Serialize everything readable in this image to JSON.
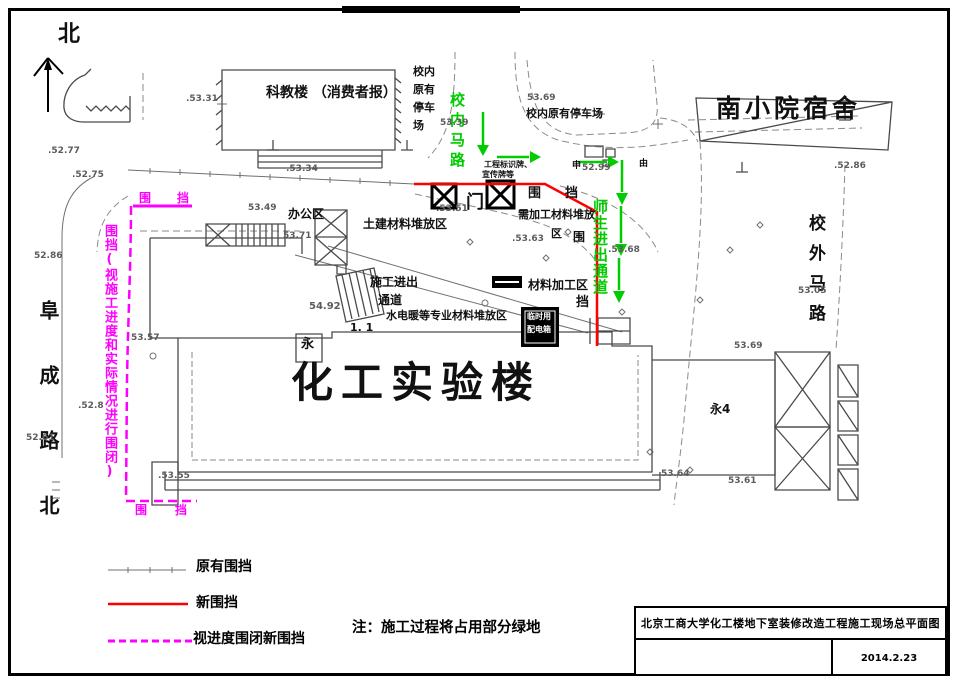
{
  "colors": {
    "text": {
      "k": "#111111",
      "g": "#5c5c5c",
      "green": "#00cc00",
      "m": "#ff00ff",
      "w": "#ffffff"
    },
    "red": "#ff0000",
    "magenta": "#ff00ff",
    "green_line": "#00cc00",
    "gray": "#8a8a8a"
  },
  "legend": {
    "items": [
      {
        "label": "原有围挡",
        "style": "existing-gray-tick-line"
      },
      {
        "label": "新围挡",
        "style": "new-red-solid-line"
      },
      {
        "label": "视进度围闭新围挡",
        "style": "progress-magenta-dashed-line"
      }
    ]
  },
  "note": "注：施工过程将占用部分绿地",
  "title_block": {
    "title": "北京工商大学化工楼地下室装修改造工程施工现场总平面图",
    "date": "2014.2.23"
  },
  "labels": [
    {
      "t": "北",
      "x": 58,
      "y": 24,
      "s": 22,
      "n": "north-label"
    },
    {
      "t": "科教楼 （消费者报）",
      "x": 266,
      "y": 86,
      "s": 14,
      "n": "building-kejiaolou"
    },
    {
      "t": "校内",
      "x": 413,
      "y": 66,
      "s": 11,
      "n": "parking-vertical-label"
    },
    {
      "t": "原有",
      "x": 413,
      "y": 84,
      "s": 11,
      "n": "parking-vertical-label"
    },
    {
      "t": "停车",
      "x": 413,
      "y": 102,
      "s": 11,
      "n": "parking-vertical-label"
    },
    {
      "t": "场",
      "x": 413,
      "y": 120,
      "s": 11,
      "n": "parking-vertical-label"
    },
    {
      "t": "校内原有停车场",
      "x": 526,
      "y": 108,
      "s": 11,
      "n": "parking-horizontal-label"
    },
    {
      "t": "南小院宿舍",
      "x": 716,
      "y": 96,
      "s": 25,
      "ls": 4,
      "n": "building-nanxiaoyuan"
    },
    {
      "t": "校内马路",
      "x": 449,
      "y": 92,
      "s": 15,
      "c": "green",
      "v": true,
      "ls": 5,
      "n": "road-xiaonei-malu"
    },
    {
      "t": "师生进出通道",
      "x": 592,
      "y": 199,
      "s": 15,
      "c": "green",
      "v": true,
      "ls": 1,
      "n": "passage-shisheng"
    },
    {
      "t": "校外马路",
      "x": 806,
      "y": 214,
      "s": 17,
      "v": true,
      "ls": 13,
      "n": "road-xiaowai-malu"
    },
    {
      "t": "阜成路北",
      "x": 38,
      "y": 300,
      "s": 20,
      "v": true,
      "ls": 45,
      "n": "road-fuchenglu-north"
    },
    {
      "t": "化工实验楼",
      "x": 291,
      "y": 362,
      "s": 42,
      "ls": 8,
      "n": "building-huagong-lab"
    },
    {
      "t": "办公区",
      "x": 288,
      "y": 208,
      "s": 12,
      "n": "area-office"
    },
    {
      "t": "土建材料堆放区",
      "x": 363,
      "y": 218,
      "s": 12,
      "n": "area-civil-materials"
    },
    {
      "t": "施工进出",
      "x": 370,
      "y": 276,
      "s": 12,
      "n": "construction-entrance-line1"
    },
    {
      "t": "通道",
      "x": 378,
      "y": 294,
      "s": 12,
      "n": "construction-entrance-line2"
    },
    {
      "t": "水电暖等专业材料堆放区",
      "x": 386,
      "y": 310,
      "s": 11,
      "n": "area-mep-materials"
    },
    {
      "t": "材料加工区",
      "x": 528,
      "y": 279,
      "s": 12,
      "n": "area-material-processing"
    },
    {
      "t": "需加工材料堆放",
      "x": 518,
      "y": 209,
      "s": 11,
      "n": "area-to-process-line1"
    },
    {
      "t": "区",
      "x": 551,
      "y": 228,
      "s": 11,
      "n": "area-to-process-line2"
    },
    {
      "t": "门",
      "x": 466,
      "y": 194,
      "s": 18,
      "n": "gate-label"
    },
    {
      "t": "围",
      "x": 528,
      "y": 187,
      "s": 13,
      "n": "fence-char"
    },
    {
      "t": "挡",
      "x": 565,
      "y": 187,
      "s": 13,
      "n": "fence-char"
    },
    {
      "t": "围",
      "x": 573,
      "y": 231,
      "s": 12,
      "n": "fence-char"
    },
    {
      "t": "挡",
      "x": 576,
      "y": 296,
      "s": 13,
      "n": "fence-char"
    },
    {
      "t": "工程标识牌、",
      "x": 484,
      "y": 161,
      "s": 8,
      "n": "sign-board-note-line1"
    },
    {
      "t": "宣传牌等",
      "x": 482,
      "y": 171,
      "s": 8,
      "n": "sign-board-note-line2"
    },
    {
      "t": "申",
      "x": 572,
      "y": 162,
      "s": 9,
      "n": "pole-mark"
    },
    {
      "t": "由",
      "x": 639,
      "y": 160,
      "s": 9,
      "n": "pole-mark"
    },
    {
      "t": "永",
      "x": 301,
      "y": 338,
      "s": 13,
      "n": "hydrant-label"
    },
    {
      "t": "永4",
      "x": 710,
      "y": 403,
      "s": 12,
      "n": "hydrant-label-4"
    },
    {
      "t": "1. 1",
      "x": 350,
      "y": 322,
      "s": 11,
      "n": "dim-label"
    },
    {
      "t": "围",
      "x": 139,
      "y": 192,
      "s": 12,
      "c": "m",
      "n": "magenta-fence-char"
    },
    {
      "t": "挡",
      "x": 177,
      "y": 192,
      "s": 12,
      "c": "m",
      "n": "magenta-fence-char"
    },
    {
      "t": "围挡(视施工进度和实际情况进行围闭)",
      "x": 103,
      "y": 224,
      "s": 13,
      "c": "m",
      "v": true,
      "ls": 1,
      "n": "fence-progress-note"
    },
    {
      "t": "围",
      "x": 135,
      "y": 504,
      "s": 12,
      "c": "m",
      "n": "magenta-fence-char"
    },
    {
      "t": "挡",
      "x": 175,
      "y": 504,
      "s": 12,
      "c": "m",
      "n": "magenta-fence-char"
    },
    {
      "t": "临时用",
      "x": 527,
      "y": 313,
      "s": 8,
      "c": "w",
      "n": "power-box-line1"
    },
    {
      "t": "配电箱",
      "x": 527,
      "y": 326,
      "s": 8,
      "c": "w",
      "n": "power-box-line2"
    },
    {
      "t": ".53.31",
      "x": 186,
      "y": 95,
      "s": 9,
      "c": "g",
      "n": "elevation"
    },
    {
      "t": ".52.77",
      "x": 48,
      "y": 147,
      "s": 9,
      "c": "g",
      "n": "elevation"
    },
    {
      "t": ".52.75",
      "x": 72,
      "y": 171,
      "s": 9,
      "c": "g",
      "n": "elevation"
    },
    {
      "t": "52.86",
      "x": 34,
      "y": 252,
      "s": 9,
      "c": "g",
      "n": "elevation"
    },
    {
      "t": ".53.34",
      "x": 286,
      "y": 165,
      "s": 9,
      "c": "g",
      "n": "elevation"
    },
    {
      "t": "53.49",
      "x": 248,
      "y": 204,
      "s": 9,
      "c": "g",
      "n": "elevation"
    },
    {
      "t": "53.71",
      "x": 283,
      "y": 232,
      "s": 9,
      "c": "g",
      "n": "elevation"
    },
    {
      "t": ".53.51",
      "x": 436,
      "y": 205,
      "s": 9,
      "c": "g",
      "n": "elevation"
    },
    {
      "t": ".53.63",
      "x": 512,
      "y": 235,
      "s": 9,
      "c": "g",
      "n": "elevation"
    },
    {
      "t": "53.69",
      "x": 527,
      "y": 94,
      "s": 9,
      "c": "g",
      "n": "elevation"
    },
    {
      "t": "53.39",
      "x": 440,
      "y": 119,
      "s": 9,
      "c": "g",
      "n": "elevation"
    },
    {
      "t": "52.99",
      "x": 582,
      "y": 164,
      "s": 9,
      "c": "g",
      "n": "elevation"
    },
    {
      "t": ".53.68",
      "x": 608,
      "y": 246,
      "s": 9,
      "c": "g",
      "n": "elevation"
    },
    {
      "t": ".52.86",
      "x": 834,
      "y": 162,
      "s": 9,
      "c": "g",
      "n": "elevation"
    },
    {
      "t": "53.05",
      "x": 798,
      "y": 287,
      "s": 9,
      "c": "g",
      "n": "elevation"
    },
    {
      "t": "53.69",
      "x": 734,
      "y": 342,
      "s": 9,
      "c": "g",
      "n": "elevation"
    },
    {
      "t": "53.57",
      "x": 131,
      "y": 334,
      "s": 9,
      "c": "g",
      "n": "elevation"
    },
    {
      "t": ".52.8",
      "x": 78,
      "y": 402,
      "s": 9,
      "c": "g",
      "n": "elevation"
    },
    {
      "t": "52.61",
      "x": 26,
      "y": 434,
      "s": 9,
      "c": "g",
      "n": "elevation"
    },
    {
      "t": ".53.55",
      "x": 158,
      "y": 472,
      "s": 9,
      "c": "g",
      "n": "elevation"
    },
    {
      "t": "53.64",
      "x": 661,
      "y": 470,
      "s": 9,
      "c": "g",
      "n": "elevation"
    },
    {
      "t": "53.61",
      "x": 728,
      "y": 477,
      "s": 9,
      "c": "g",
      "n": "elevation"
    },
    {
      "t": "54.92",
      "x": 309,
      "y": 302,
      "s": 10,
      "c": "g",
      "n": "elevation"
    }
  ]
}
